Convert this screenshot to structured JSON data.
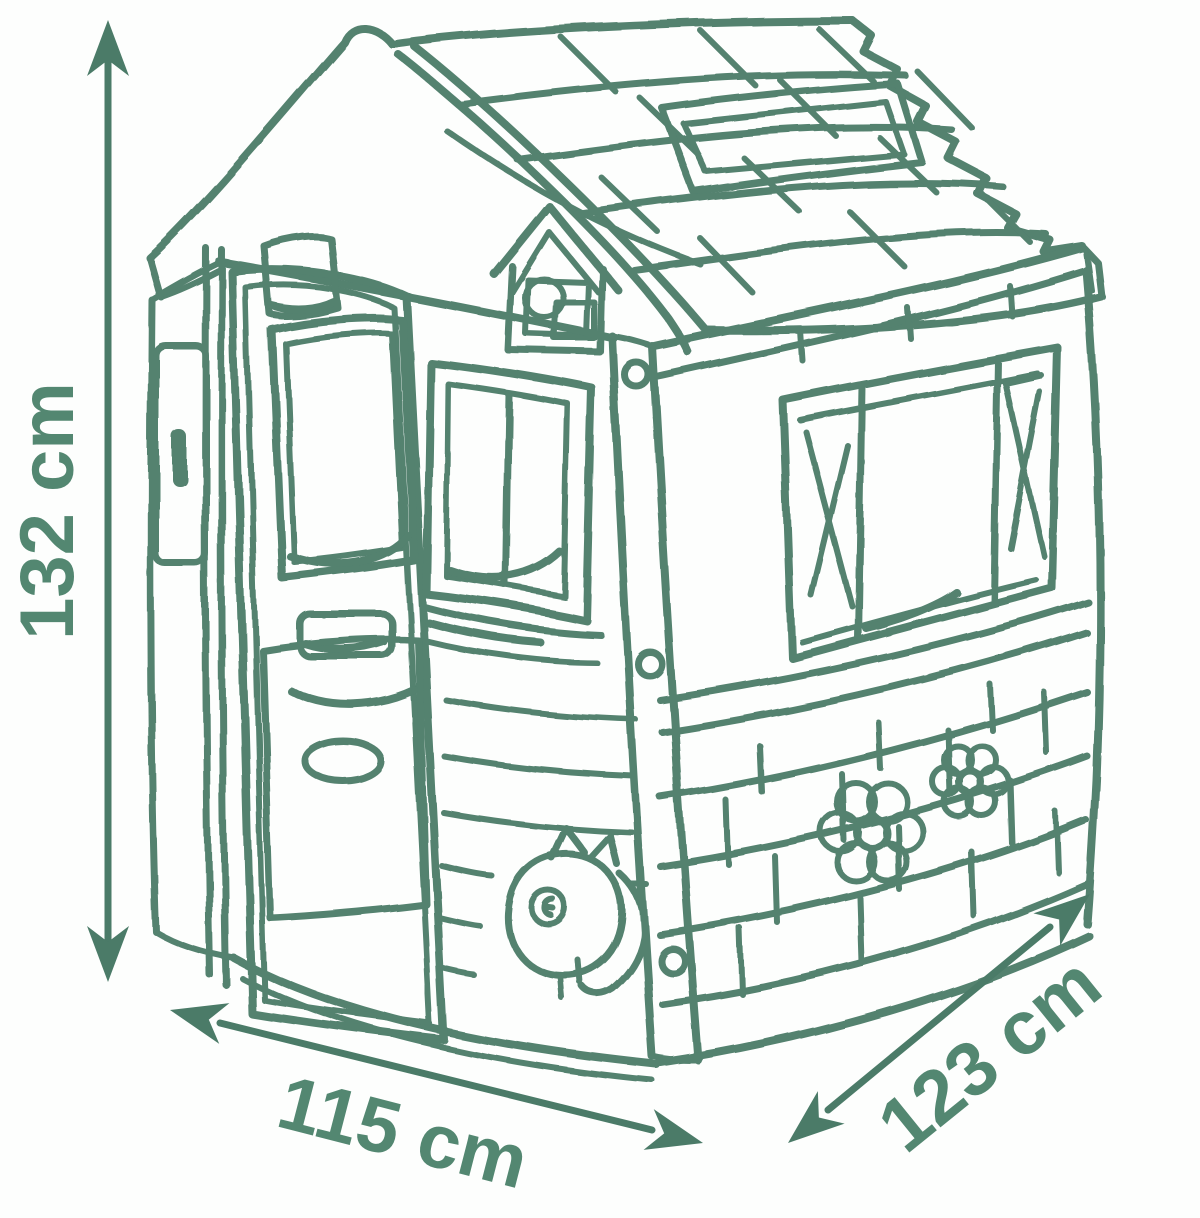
{
  "diagram": {
    "type": "product-dimension-sketch",
    "subject": "kids playhouse line sketch",
    "colors": {
      "line": "#4b7b68",
      "text": "#538771",
      "background": "#fdfefd"
    },
    "dimensions": {
      "height": {
        "label": "132 cm"
      },
      "width": {
        "label": "115 cm"
      },
      "depth": {
        "label": "123 cm"
      }
    }
  }
}
